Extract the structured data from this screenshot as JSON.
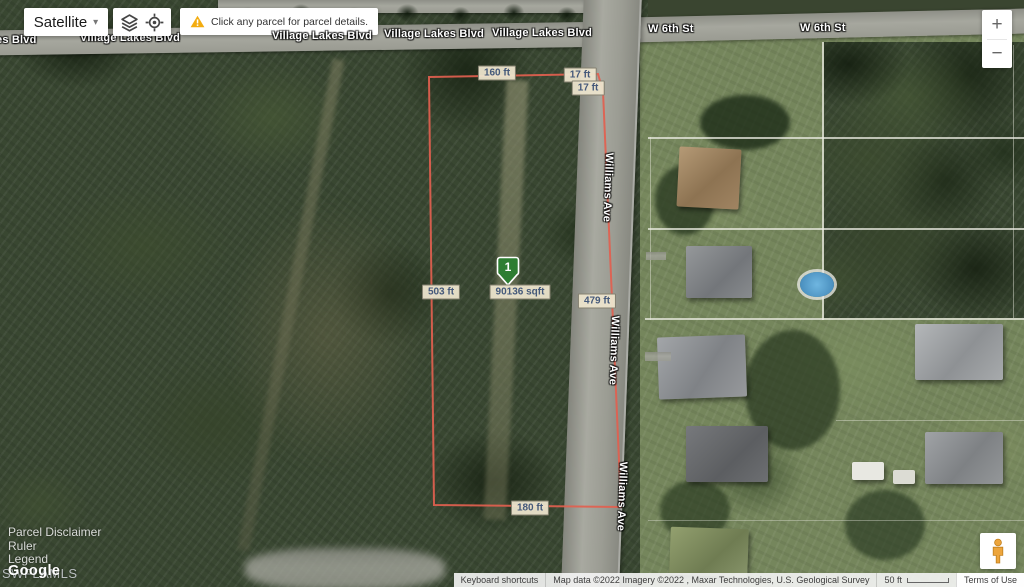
{
  "controls": {
    "map_type": "Satellite",
    "caret": "▾",
    "notice": "Click any parcel for parcel details.",
    "zoom_in": "+",
    "zoom_out": "−"
  },
  "streets": {
    "vlb_clip": "es Blvd",
    "vlb1": "Village Lakes Blvd",
    "vlb2": "Village Lakes Blvd",
    "vlb3": "Village Lakes Blvd",
    "vlb4": "Village Lakes Blvd",
    "w6a": "W 6th St",
    "w6b": "W 6th St",
    "williams1": "Williams Ave",
    "williams2": "Williams Ave",
    "williams3": "Williams Ave"
  },
  "parcel": {
    "marker": "1",
    "area": "90136 sqft",
    "top": "160 ft",
    "jog1": "17 ft",
    "jog2": "17 ft",
    "left": "503 ft",
    "right": "479 ft",
    "bottom": "180 ft",
    "outline_color": "#e2604f",
    "marker_color": "#2e7d32"
  },
  "links": {
    "parcel_disclaimer": "Parcel Disclaimer",
    "ruler": "Ruler",
    "legend": "Legend"
  },
  "watermarks": {
    "google": "Google",
    "mls": "SWFLAMLS"
  },
  "statusbar": {
    "keyboard": "Keyboard shortcuts",
    "attribution": "Map data ©2022 Imagery ©2022 , Maxar Technologies, U.S. Geological Survey",
    "scale": "50 ft",
    "terms": "Terms of Use"
  }
}
